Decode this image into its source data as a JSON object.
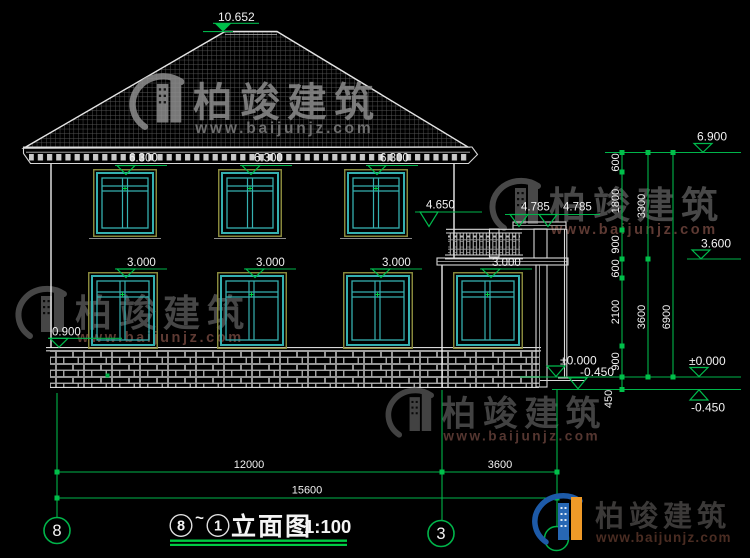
{
  "brand": {
    "name": "柏竣建筑",
    "site": "www.baijunjz.com"
  },
  "levels": {
    "roof_peak": "10.652",
    "eave_top": "6.900",
    "win2_head": "6.300",
    "floor2": "3.600",
    "balcony_rail": "4.650",
    "porch_roof_a": "4.785",
    "porch_roof_b": "4.785",
    "win1_head": "3.000",
    "win1_sill": "0.900",
    "ground_zero": "±0.000",
    "site_level": "-0.450"
  },
  "dims": {
    "right_inner": [
      "600",
      "1800",
      "900",
      "600",
      "2100",
      "900",
      "450"
    ],
    "right_mid": [
      "3300",
      "3600"
    ],
    "right_outer": "6900",
    "bottom": [
      "12000",
      "3600",
      "15600"
    ]
  },
  "grid": {
    "left": "8",
    "right": "3"
  },
  "title": {
    "from": "8",
    "tilde": "~",
    "to": "1",
    "name": "立面图",
    "scale": "1:100"
  }
}
